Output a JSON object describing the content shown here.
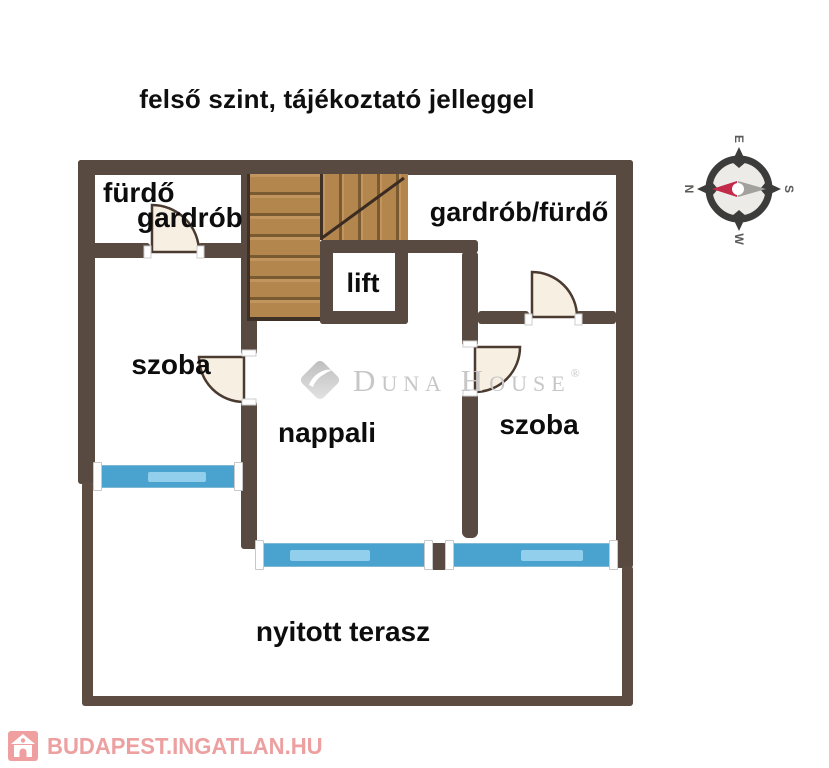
{
  "title": "felső szint, tájékoztató jelleggel",
  "rooms": {
    "furdo": {
      "label": "fürdő"
    },
    "gardrob": {
      "label": "gardrób"
    },
    "gardrob_furdo": {
      "label": "gardrób/fürdő"
    },
    "lift": {
      "label": "lift"
    },
    "szoba_left": {
      "label": "szoba"
    },
    "nappali": {
      "label": "nappali"
    },
    "szoba_right": {
      "label": "szoba"
    },
    "terasz": {
      "label": "nyitott terasz"
    }
  },
  "compass": {
    "north": "N",
    "east": "E",
    "south": "S",
    "west": "W"
  },
  "watermarks": {
    "duna_house": {
      "brand": "Duna House",
      "registered": "®"
    },
    "listing_site": {
      "text": "BUDAPEST.INGATLAN.HU"
    }
  },
  "colors": {
    "wall": "#594a41",
    "stairs_wood": "#b3864e",
    "stairs_gap": "#7a5a31",
    "window_blue": "#4aa2ce",
    "window_pane": "#92cfec",
    "door_fill": "#f7efe2",
    "watermark_gray": "#c7c7c7",
    "listing_pink": "#eca0a0",
    "compass_needle_red": "#c22a4a"
  }
}
